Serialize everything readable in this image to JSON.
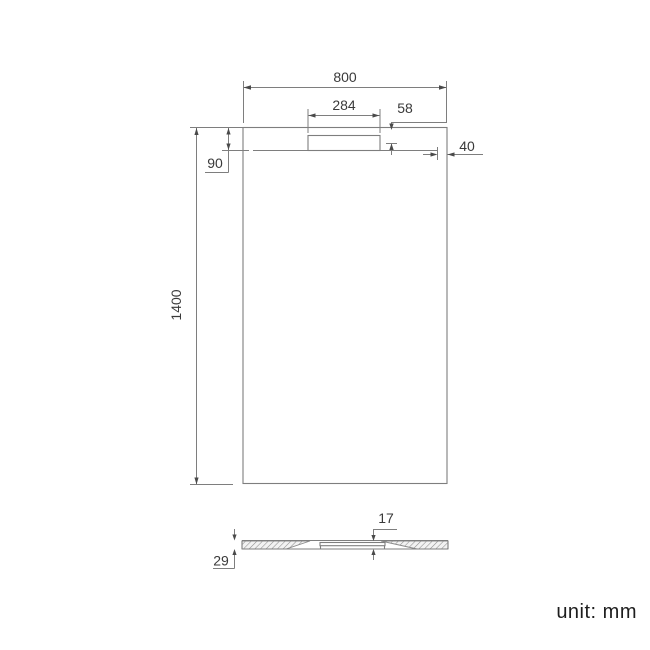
{
  "drawing": {
    "unit_label": "unit: mm",
    "top_view": {
      "width_label": "800",
      "cover_width_label": "284",
      "cover_depth_label": "58",
      "edge_offset_label": "90",
      "side_offset_label": "40",
      "length_label": "1400"
    },
    "section_view": {
      "center_thickness_label": "17",
      "edge_thickness_label": "29"
    },
    "colors": {
      "line": "#7e7e7e",
      "arrow": "#4a4a4a",
      "text": "#3a3a3a"
    }
  }
}
